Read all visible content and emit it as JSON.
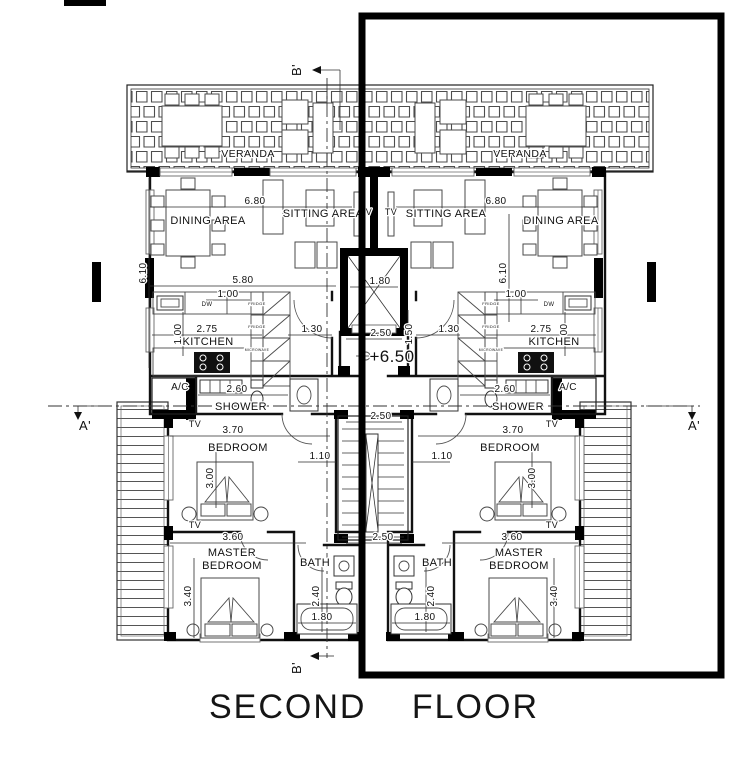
{
  "drawing": {
    "title": "SECOND FLOOR"
  },
  "colors": {
    "ink": "#111111",
    "highlight": "#000000",
    "paper": "#ffffff"
  },
  "labels": [
    {
      "n": "veranda-left",
      "t": "VERANDA",
      "x": 248,
      "y": 157,
      "s": 10.5
    },
    {
      "n": "veranda-right",
      "t": "VERANDA",
      "x": 520,
      "y": 157,
      "s": 10.5
    },
    {
      "n": "dining-area-left",
      "t": "DINING AREA",
      "x": 208,
      "y": 224,
      "s": 11
    },
    {
      "n": "sitting-area-left",
      "t": "SITTING AREA",
      "x": 323,
      "y": 217,
      "s": 11
    },
    {
      "n": "tv-sitting-left",
      "t": "TV",
      "x": 366,
      "y": 215,
      "s": 9
    },
    {
      "n": "tv-sitting-right",
      "t": "TV",
      "x": 391,
      "y": 215,
      "s": 9
    },
    {
      "n": "sitting-area-right",
      "t": "SITTING AREA",
      "x": 446,
      "y": 217,
      "s": 11
    },
    {
      "n": "dining-area-right",
      "t": "DINING AREA",
      "x": 561,
      "y": 224,
      "s": 11
    },
    {
      "n": "dim-680-left",
      "t": "6.80",
      "x": 255,
      "y": 204
    },
    {
      "n": "dim-680-right",
      "t": "6.80",
      "x": 496,
      "y": 204
    },
    {
      "n": "dim-610-left",
      "t": "6.10",
      "x": 146,
      "y": 273,
      "r": -90
    },
    {
      "n": "dim-610-right",
      "t": "6.10",
      "x": 506,
      "y": 273,
      "r": -90
    },
    {
      "n": "dim-580-left",
      "t": "5.80",
      "x": 243,
      "y": 283
    },
    {
      "n": "dim-100-left",
      "t": "1.00",
      "x": 228,
      "y": 297
    },
    {
      "n": "dim-100-right",
      "t": "1.00",
      "x": 516,
      "y": 297
    },
    {
      "n": "dim-275-left",
      "t": "2.75",
      "x": 207,
      "y": 332
    },
    {
      "n": "dim-275-right",
      "t": "2.75",
      "x": 541,
      "y": 332
    },
    {
      "n": "dim-100v-left",
      "t": "1.00",
      "x": 181,
      "y": 334,
      "r": -90
    },
    {
      "n": "dim-100v-right",
      "t": "1.00",
      "x": 567,
      "y": 334,
      "r": -90
    },
    {
      "n": "kitchen-left",
      "t": "KITCHEN",
      "x": 208,
      "y": 345,
      "s": 11
    },
    {
      "n": "kitchen-right",
      "t": "KITCHEN",
      "x": 554,
      "y": 345,
      "s": 11
    },
    {
      "n": "dw-left",
      "t": "DW",
      "x": 207,
      "y": 306,
      "s": 6
    },
    {
      "n": "dw-right",
      "t": "DW",
      "x": 549,
      "y": 306,
      "s": 6
    },
    {
      "n": "fridge-left-1",
      "t": "FRIDGE",
      "x": 257,
      "y": 305,
      "s": 4
    },
    {
      "n": "fridge-left-2",
      "t": "FRIDGE",
      "x": 257,
      "y": 328,
      "s": 4
    },
    {
      "n": "microwave-left",
      "t": "MICROWAVE",
      "x": 257,
      "y": 351,
      "s": 3.4
    },
    {
      "n": "fridge-right-1",
      "t": "FRIDGE",
      "x": 491,
      "y": 305,
      "s": 4
    },
    {
      "n": "fridge-right-2",
      "t": "FRIDGE",
      "x": 491,
      "y": 328,
      "s": 4
    },
    {
      "n": "microwave-right",
      "t": "MICROWAVE",
      "x": 491,
      "y": 351,
      "s": 3.4
    },
    {
      "n": "dim-130-left",
      "t": "1.30",
      "x": 312,
      "y": 332
    },
    {
      "n": "dim-130-right",
      "t": "1.30",
      "x": 449,
      "y": 332
    },
    {
      "n": "dim-180-elevator",
      "t": "1.80",
      "x": 380,
      "y": 284
    },
    {
      "n": "dim-250-center-1",
      "t": "2.50",
      "x": 381,
      "y": 336
    },
    {
      "n": "dim-150v-center",
      "t": "1.50",
      "x": 412,
      "y": 334,
      "r": -90
    },
    {
      "n": "level-marker",
      "t": "+6.50",
      "x": 392,
      "y": 362,
      "s": 17
    },
    {
      "n": "ac-left",
      "t": "A/C",
      "x": 180,
      "y": 390,
      "s": 10
    },
    {
      "n": "ac-right",
      "t": "A/C",
      "x": 568,
      "y": 390,
      "s": 10
    },
    {
      "n": "dim-260-left",
      "t": "2.60",
      "x": 237,
      "y": 392
    },
    {
      "n": "dim-260-right",
      "t": "2.60",
      "x": 505,
      "y": 392
    },
    {
      "n": "shower-left",
      "t": "SHOWER",
      "x": 241,
      "y": 410,
      "s": 11
    },
    {
      "n": "shower-right",
      "t": "SHOWER",
      "x": 518,
      "y": 410,
      "s": 11
    },
    {
      "n": "dim-250-center-2",
      "t": "2.50",
      "x": 381,
      "y": 419
    },
    {
      "n": "tv-bedroom-left",
      "t": "TV",
      "x": 195,
      "y": 427,
      "s": 9
    },
    {
      "n": "tv-bedroom-right",
      "t": "TV",
      "x": 552,
      "y": 427,
      "s": 9
    },
    {
      "n": "dim-370-left",
      "t": "3.70",
      "x": 233,
      "y": 433
    },
    {
      "n": "dim-370-right",
      "t": "3.70",
      "x": 513,
      "y": 433
    },
    {
      "n": "bedroom-left",
      "t": "BEDROOM",
      "x": 238,
      "y": 451,
      "s": 11
    },
    {
      "n": "bedroom-right",
      "t": "BEDROOM",
      "x": 510,
      "y": 451,
      "s": 11
    },
    {
      "n": "dim-110-left",
      "t": "1.10",
      "x": 320,
      "y": 459
    },
    {
      "n": "dim-110-right",
      "t": "1.10",
      "x": 442,
      "y": 459
    },
    {
      "n": "dim-300v-left",
      "t": "3.00",
      "x": 213,
      "y": 478,
      "r": -90
    },
    {
      "n": "dim-300v-right",
      "t": "3.00",
      "x": 535,
      "y": 478,
      "r": -90
    },
    {
      "n": "tv-master-left",
      "t": "TV",
      "x": 195,
      "y": 528,
      "s": 9
    },
    {
      "n": "tv-master-right",
      "t": "TV",
      "x": 552,
      "y": 528,
      "s": 9
    },
    {
      "n": "dim-250-center-3",
      "t": "2.50",
      "x": 383,
      "y": 540
    },
    {
      "n": "dim-360-left",
      "t": "3.60",
      "x": 233,
      "y": 540
    },
    {
      "n": "dim-360-right",
      "t": "3.60",
      "x": 512,
      "y": 540
    },
    {
      "n": "master-bedroom-left-1",
      "t": "MASTER",
      "x": 232,
      "y": 556,
      "s": 11
    },
    {
      "n": "master-bedroom-left-2",
      "t": "BEDROOM",
      "x": 232,
      "y": 569,
      "s": 11
    },
    {
      "n": "master-bedroom-right-1",
      "t": "MASTER",
      "x": 519,
      "y": 556,
      "s": 11
    },
    {
      "n": "master-bedroom-right-2",
      "t": "BEDROOM",
      "x": 519,
      "y": 569,
      "s": 11
    },
    {
      "n": "bath-left",
      "t": "BATH",
      "x": 315,
      "y": 566,
      "s": 11
    },
    {
      "n": "bath-right",
      "t": "BATH",
      "x": 437,
      "y": 566,
      "s": 11
    },
    {
      "n": "dim-340v-left",
      "t": "3.40",
      "x": 191,
      "y": 596,
      "r": -90
    },
    {
      "n": "dim-340v-right",
      "t": "3.40",
      "x": 557,
      "y": 596,
      "r": -90
    },
    {
      "n": "dim-240v-left",
      "t": "2.40",
      "x": 319,
      "y": 596,
      "r": -90
    },
    {
      "n": "dim-240v-right",
      "t": "2.40",
      "x": 434,
      "y": 596,
      "r": -90
    },
    {
      "n": "dim-180-bath-left",
      "t": "1.80",
      "x": 322,
      "y": 620
    },
    {
      "n": "dim-180-bath-right",
      "t": "1.80",
      "x": 425,
      "y": 620
    },
    {
      "n": "section-b-top",
      "t": "B'",
      "x": 301,
      "y": 70,
      "r": -90,
      "s": 13
    },
    {
      "n": "section-b-bottom",
      "t": "B'",
      "x": 301,
      "y": 668,
      "r": -90,
      "s": 13
    },
    {
      "n": "section-a-left",
      "t": "A'",
      "x": 85,
      "y": 430,
      "s": 13
    },
    {
      "n": "section-a-right",
      "t": "A'",
      "x": 694,
      "y": 430,
      "s": 13
    }
  ]
}
